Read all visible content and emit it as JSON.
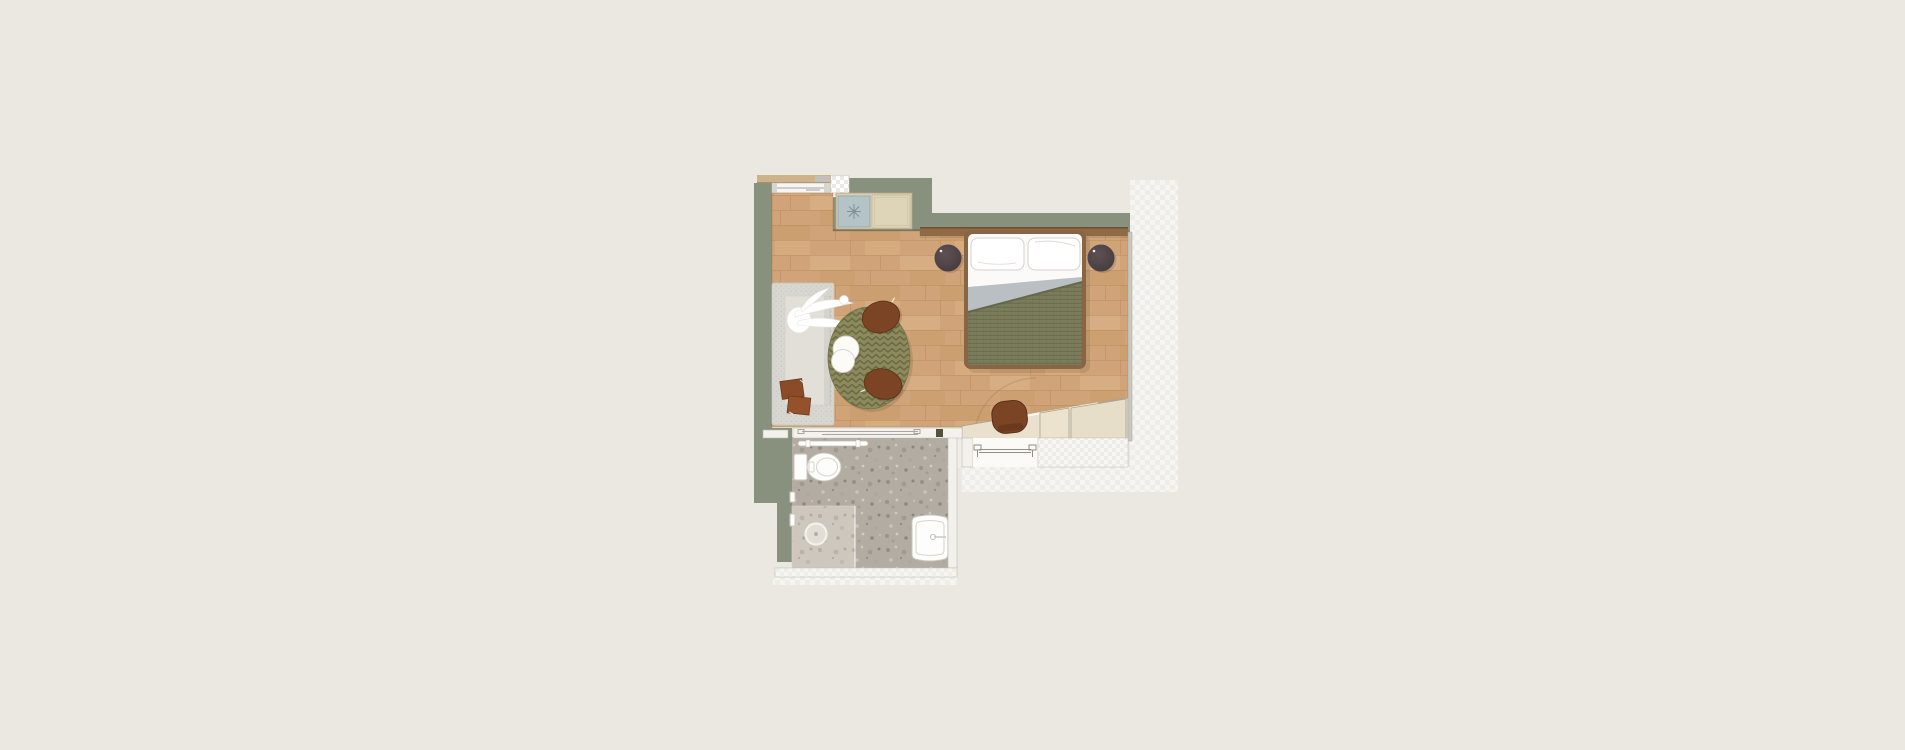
{
  "meta": {
    "type": "architectural-floor-plan",
    "description": "Top-down rendered floor plan of a hotel guest room: combined bedroom and lounge area with wood flooring, a kitchenette niche, a terrazzo-floored bathroom below, and an entry with sliding door at bottom right."
  },
  "palette": {
    "background": "#EAE8E1",
    "wall_green": "#87917D",
    "wall_light": "#F3F1EC",
    "wood_floor": "#D0A478",
    "wood_line": "#B58657",
    "headboard": "#8F6A45",
    "duvet": "#7A7C5C",
    "duvet_line": "#696B4D",
    "sheet_gray": "#B9BFC3",
    "stool_dark": "#4E4245",
    "sofa_gray": "#D8D6D0",
    "rug_olive": "#8D8B5E",
    "rug_line": "#6C6C46",
    "pouf_brown": "#7B4425",
    "table_brown": "#8C4B28",
    "terrazzo": "#B3ACA3",
    "shower": "#CDC7BD",
    "cabinet_beige": "#E9E1CD",
    "halo": "#EFEDE7",
    "white": "#FDFDFB"
  },
  "rooms": [
    {
      "name": "bedroom-lounge",
      "floor": "wood-planks",
      "furniture": [
        "double-bed-with-olive-duvet",
        "pillow-left",
        "pillow-right",
        "bedside-stool-left",
        "bedside-stool-right",
        "headboard-shelf",
        "daybed-sofa",
        "white-sculpture-decor",
        "brown-side-tables",
        "round-chevron-rug",
        "lounge-pouf-top",
        "lounge-pouf-bottom",
        "nesting-coffee-tables",
        "kitchenette-minibar-unit",
        "angled-desk-console",
        "built-in-wardrobe",
        "desk-chair"
      ]
    },
    {
      "name": "bathroom",
      "floor": "terrazzo",
      "furniture": [
        "toilet",
        "walk-in-shower-with-drain",
        "washbasin",
        "towel-rail",
        "sliding-door"
      ]
    },
    {
      "name": "entry",
      "furniture": [
        "sliding-entry-door",
        "door-swing-arc"
      ]
    }
  ],
  "openings": [
    "window-top-left",
    "bathroom-sliding-door",
    "entry-sliding-door"
  ]
}
